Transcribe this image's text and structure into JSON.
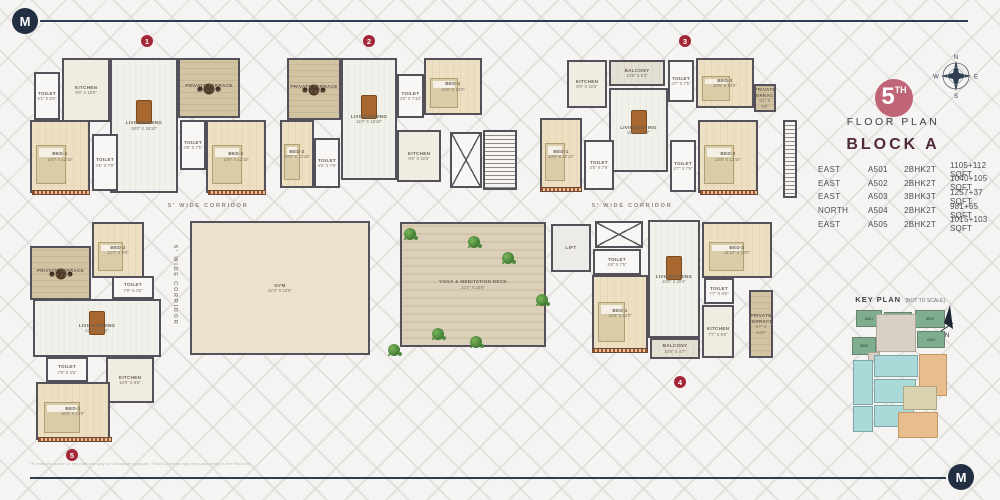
{
  "logo": {
    "letter": "M"
  },
  "panel": {
    "compass": {
      "n": "N",
      "e": "E",
      "s": "S",
      "w": "W"
    },
    "floor_badge": {
      "number": "5",
      "suffix": "TH"
    },
    "floor_label": "FLOOR PLAN",
    "block_title": "BLOCK A",
    "accent_colors": {
      "badge": "#c06577",
      "marker": "#a32638",
      "navy": "#2e3d52",
      "title": "#4f2b37"
    },
    "units_table": {
      "rows": [
        {
          "facing": "EAST",
          "unit": "A501",
          "type": "2BHK2T",
          "area": "1105+112 SQFT"
        },
        {
          "facing": "EAST",
          "unit": "A502",
          "type": "2BHK2T",
          "area": "1040+105 SQFT"
        },
        {
          "facing": "EAST",
          "unit": "A503",
          "type": "3BHK3T",
          "area": "1257+37 SQFT"
        },
        {
          "facing": "NORTH",
          "unit": "A504",
          "type": "2BHK2T",
          "area": "981+65 SQFT"
        },
        {
          "facing": "EAST",
          "unit": "A505",
          "type": "2BHK2T",
          "area": "1015+103 SQFT"
        }
      ]
    },
    "key_plan": {
      "title": "KEY PLAN",
      "note": "[NOT TO SCALE]",
      "north_label": "N",
      "colors": {
        "green": "#7fae8e",
        "teal": "#abd8d8",
        "orange": "#e9bd8d",
        "beige": "#d9d2b0",
        "corridor": "#d8d0c4"
      },
      "blocks": [
        {
          "x": 856,
          "y": 310,
          "w": 26,
          "h": 17,
          "c": "g",
          "label": "A501"
        },
        {
          "x": 884,
          "y": 312,
          "w": 28,
          "h": 16,
          "c": "g",
          "label": "A502"
        },
        {
          "x": 915,
          "y": 310,
          "w": 30,
          "h": 18,
          "c": "g",
          "label": "A503"
        },
        {
          "x": 852,
          "y": 337,
          "w": 24,
          "h": 18,
          "c": "g",
          "label": "A505"
        },
        {
          "x": 917,
          "y": 331,
          "w": 28,
          "h": 17,
          "c": "g",
          "label": "A504"
        },
        {
          "x": 876,
          "y": 314,
          "w": 40,
          "h": 38,
          "c": "cor",
          "label": ""
        },
        {
          "x": 868,
          "y": 352,
          "w": 12,
          "h": 10,
          "c": "cor",
          "label": ""
        },
        {
          "x": 874,
          "y": 355,
          "w": 44,
          "h": 22,
          "c": "t",
          "label": ""
        },
        {
          "x": 874,
          "y": 379,
          "w": 42,
          "h": 24,
          "c": "t",
          "label": ""
        },
        {
          "x": 874,
          "y": 405,
          "w": 40,
          "h": 22,
          "c": "t",
          "label": ""
        },
        {
          "x": 853,
          "y": 360,
          "w": 20,
          "h": 45,
          "c": "t",
          "label": ""
        },
        {
          "x": 853,
          "y": 406,
          "w": 20,
          "h": 26,
          "c": "t",
          "label": ""
        },
        {
          "x": 919,
          "y": 354,
          "w": 28,
          "h": 42,
          "c": "o",
          "label": ""
        },
        {
          "x": 898,
          "y": 412,
          "w": 40,
          "h": 26,
          "c": "o",
          "label": ""
        },
        {
          "x": 903,
          "y": 386,
          "w": 34,
          "h": 24,
          "c": "be",
          "label": ""
        }
      ]
    }
  },
  "floor_plan": {
    "corridor_label": "5' WIDE CORRIDOR",
    "markers": [
      {
        "n": "1",
        "x": 141,
        "y": 35
      },
      {
        "n": "2",
        "x": 363,
        "y": 35
      },
      {
        "n": "3",
        "x": 679,
        "y": 35
      },
      {
        "n": "4",
        "x": 674,
        "y": 376
      },
      {
        "n": "5",
        "x": 66,
        "y": 449
      }
    ],
    "rooms": [
      {
        "id": "u1-toilet-a",
        "name": "TOILET",
        "dims": "5'1\" X 8'0\"",
        "x": 34,
        "y": 72,
        "w": 26,
        "h": 48,
        "k": "wet",
        "f": ""
      },
      {
        "id": "u1-kitchen",
        "name": "KITCHEN",
        "dims": "9'6\" X 10'6\"",
        "x": 62,
        "y": 58,
        "w": 48,
        "h": 64,
        "k": "kit",
        "f": ""
      },
      {
        "id": "u1-living",
        "name": "LIVING/DINING",
        "dims": "18'0\" X 18'10\"",
        "x": 110,
        "y": 58,
        "w": 68,
        "h": 135,
        "k": "liv",
        "f": "dining"
      },
      {
        "id": "u1-terrace",
        "name": "PRIVATE TERRACE",
        "dims": "10'4\" X 10'10\"",
        "x": 178,
        "y": 58,
        "w": 62,
        "h": 60,
        "k": "ter",
        "f": "tertable"
      },
      {
        "id": "u1-bed1",
        "name": "BED-1",
        "dims": "10'0\" X 12'10\"",
        "x": 30,
        "y": 120,
        "w": 60,
        "h": 73,
        "k": "bed",
        "f": "bed"
      },
      {
        "id": "u1-toilet-b",
        "name": "TOILET",
        "dims": "4'5\" X 7'9\"",
        "x": 92,
        "y": 134,
        "w": 26,
        "h": 57,
        "k": "wet",
        "f": ""
      },
      {
        "id": "u1-toilet-c",
        "name": "TOILET",
        "dims": "4'5\" X 7'5\"",
        "x": 180,
        "y": 120,
        "w": 26,
        "h": 50,
        "k": "wet",
        "f": ""
      },
      {
        "id": "u1-bed2",
        "name": "BED-2",
        "dims": "10'6\" X 12'10\"",
        "x": 206,
        "y": 120,
        "w": 60,
        "h": 73,
        "k": "bed",
        "f": "bed"
      },
      {
        "id": "u2-terrace",
        "name": "PRIVATE TERRACE",
        "dims": "9'8\" X 10'10\"",
        "x": 287,
        "y": 58,
        "w": 54,
        "h": 62,
        "k": "ter",
        "f": "tertable"
      },
      {
        "id": "u2-living",
        "name": "LIVING/DINING",
        "dims": "11'0\" X 18'10\"",
        "x": 341,
        "y": 58,
        "w": 56,
        "h": 122,
        "k": "liv",
        "f": "dining"
      },
      {
        "id": "u2-toilet-a",
        "name": "TOILET",
        "dims": "4'5\" X 7'10\"",
        "x": 397,
        "y": 74,
        "w": 27,
        "h": 44,
        "k": "wet",
        "f": ""
      },
      {
        "id": "u2-bed1",
        "name": "BED-1",
        "dims": "10'6\" X 12'0\"",
        "x": 424,
        "y": 58,
        "w": 58,
        "h": 57,
        "k": "bed",
        "f": "bed"
      },
      {
        "id": "u2-bed2",
        "name": "BED-2",
        "dims": "10'0\" X 12'10\"",
        "x": 280,
        "y": 120,
        "w": 34,
        "h": 68,
        "k": "bed",
        "f": "bed"
      },
      {
        "id": "u2-toilet-b",
        "name": "TOILET",
        "dims": "4'5\" X 7'9\"",
        "x": 314,
        "y": 138,
        "w": 26,
        "h": 50,
        "k": "wet",
        "f": ""
      },
      {
        "id": "u2-kitchen",
        "name": "KITCHEN",
        "dims": "9'2\" X 10'5\"",
        "x": 397,
        "y": 130,
        "w": 44,
        "h": 52,
        "k": "kit",
        "f": ""
      },
      {
        "id": "u3-kitchen",
        "name": "KITCHEN",
        "dims": "8'0\" X 10'6\"",
        "x": 567,
        "y": 60,
        "w": 40,
        "h": 48,
        "k": "kit",
        "f": ""
      },
      {
        "id": "u3-balcony",
        "name": "BALCONY",
        "dims": "10'6\" X 8'3\"",
        "x": 609,
        "y": 60,
        "w": 56,
        "h": 26,
        "k": "bal",
        "f": ""
      },
      {
        "id": "u3-toilet-a",
        "name": "TOILET",
        "dims": "4'7\" X 7'5\"",
        "x": 668,
        "y": 60,
        "w": 26,
        "h": 42,
        "k": "wet",
        "f": ""
      },
      {
        "id": "u3-bed3",
        "name": "BED-3",
        "dims": "10'6\" X 10'6\"",
        "x": 696,
        "y": 58,
        "w": 58,
        "h": 50,
        "k": "bed",
        "f": "bed"
      },
      {
        "id": "u3-terrace",
        "name": "PRIVATE TERRACE",
        "dims": "8'1\" X 9'9\"",
        "x": 754,
        "y": 84,
        "w": 22,
        "h": 28,
        "k": "ter",
        "f": ""
      },
      {
        "id": "u3-living",
        "name": "LIVING/DINING",
        "dims": "11'0\" X 16'7\"",
        "x": 609,
        "y": 88,
        "w": 59,
        "h": 84,
        "k": "liv",
        "f": "dining"
      },
      {
        "id": "u3-bed1",
        "name": "BED-1",
        "dims": "10'6\" X 12'10\"",
        "x": 540,
        "y": 118,
        "w": 42,
        "h": 72,
        "k": "bed",
        "f": "bed"
      },
      {
        "id": "u3-toilet-b",
        "name": "TOILET",
        "dims": "4'5\" X 7'9\"",
        "x": 584,
        "y": 140,
        "w": 30,
        "h": 50,
        "k": "wet",
        "f": ""
      },
      {
        "id": "u3-toilet-c",
        "name": "TOILET",
        "dims": "4'7\" X 7'9\"",
        "x": 670,
        "y": 140,
        "w": 26,
        "h": 52,
        "k": "wet",
        "f": ""
      },
      {
        "id": "u3-bed2",
        "name": "BED-2",
        "dims": "10'6\" X 12'10\"",
        "x": 698,
        "y": 120,
        "w": 60,
        "h": 73,
        "k": "bed",
        "f": "bed"
      },
      {
        "id": "u4-toilet-a",
        "name": "TOILET",
        "dims": "5'8\" X 7'5\"",
        "x": 593,
        "y": 249,
        "w": 48,
        "h": 26,
        "k": "wet",
        "f": ""
      },
      {
        "id": "u4-bed1",
        "name": "BED-1",
        "dims": "10'6\" X 12'0\"",
        "x": 592,
        "y": 275,
        "w": 56,
        "h": 76,
        "k": "bed",
        "f": "bed"
      },
      {
        "id": "u4-living",
        "name": "LIVING/DINING",
        "dims": "10'0\" X 20'4\"",
        "x": 648,
        "y": 220,
        "w": 52,
        "h": 118,
        "k": "liv",
        "f": "dining"
      },
      {
        "id": "u4-bed2",
        "name": "BED-2",
        "dims": "11'10\" X 10'0\"",
        "x": 702,
        "y": 222,
        "w": 70,
        "h": 56,
        "k": "bed",
        "f": "bed"
      },
      {
        "id": "u4-toilet-b",
        "name": "TOILET",
        "dims": "7'7\" X 4'5\"",
        "x": 704,
        "y": 278,
        "w": 30,
        "h": 26,
        "k": "wet",
        "f": ""
      },
      {
        "id": "u4-kitchen",
        "name": "KITCHEN",
        "dims": "7'7\" X 9'6\"",
        "x": 702,
        "y": 305,
        "w": 32,
        "h": 53,
        "k": "kit",
        "f": ""
      },
      {
        "id": "u4-terrace",
        "name": "PRIVATE TERRACE",
        "dims": "4'7\" X 14'5\"",
        "x": 749,
        "y": 290,
        "w": 24,
        "h": 68,
        "k": "ter",
        "f": ""
      },
      {
        "id": "u4-balcony",
        "name": "BALCONY",
        "dims": "10'0\" X 4'7\"",
        "x": 650,
        "y": 338,
        "w": 50,
        "h": 21,
        "k": "bal",
        "f": ""
      },
      {
        "id": "u5-bed2",
        "name": "BED-2",
        "dims": "12'7\" X 9'8\"",
        "x": 92,
        "y": 222,
        "w": 52,
        "h": 56,
        "k": "bed",
        "f": "bed"
      },
      {
        "id": "u5-terrace",
        "name": "PRIVATE TERRACE",
        "dims": "12'3\" X 9'8\"",
        "x": 30,
        "y": 246,
        "w": 61,
        "h": 54,
        "k": "ter",
        "f": "tertable"
      },
      {
        "id": "u5-toilet-a",
        "name": "TOILET",
        "dims": "7'9\" X 4'5\"",
        "x": 112,
        "y": 276,
        "w": 42,
        "h": 23,
        "k": "wet",
        "f": ""
      },
      {
        "id": "u5-living",
        "name": "LIVING/DINING",
        "dims": "23'3\" X 10'0\"",
        "x": 33,
        "y": 299,
        "w": 128,
        "h": 58,
        "k": "liv",
        "f": "dining"
      },
      {
        "id": "u5-toilet-b",
        "name": "TOILET",
        "dims": "7'9\" X 4'5\"",
        "x": 46,
        "y": 357,
        "w": 42,
        "h": 25,
        "k": "wet",
        "f": ""
      },
      {
        "id": "u5-kitchen",
        "name": "KITCHEN",
        "dims": "10'0\" X 9'6\"",
        "x": 106,
        "y": 357,
        "w": 48,
        "h": 46,
        "k": "kit",
        "f": ""
      },
      {
        "id": "u5-bed1",
        "name": "BED-1",
        "dims": "10'6\" X 13'0\"",
        "x": 36,
        "y": 382,
        "w": 74,
        "h": 58,
        "k": "bed",
        "f": "bed"
      },
      {
        "id": "gym",
        "name": "GYM",
        "dims": "32'4\" X 23'0\"",
        "x": 190,
        "y": 221,
        "w": 180,
        "h": 134,
        "k": "gym",
        "f": ""
      },
      {
        "id": "yoga-deck",
        "name": "YOGA & MEDITATION DECK",
        "dims": "32'4\" X 23'6\"",
        "x": 400,
        "y": 222,
        "w": 146,
        "h": 125,
        "k": "deck",
        "f": ""
      },
      {
        "id": "lift",
        "name": "LIFT",
        "dims": "",
        "x": 551,
        "y": 224,
        "w": 40,
        "h": 48,
        "k": "lift",
        "f": ""
      }
    ],
    "stairs": [
      {
        "x": 483,
        "y": 130,
        "w": 34,
        "h": 60
      },
      {
        "x": 783,
        "y": 120,
        "w": 14,
        "h": 78
      }
    ],
    "shafts": [
      {
        "x": 450,
        "y": 132,
        "w": 32,
        "h": 56
      },
      {
        "x": 595,
        "y": 221,
        "w": 48,
        "h": 27
      }
    ],
    "railings": [
      {
        "x": 32,
        "y": 190,
        "w": 58,
        "h": 5
      },
      {
        "x": 208,
        "y": 190,
        "w": 58,
        "h": 5
      },
      {
        "x": 700,
        "y": 190,
        "w": 58,
        "h": 5
      },
      {
        "x": 540,
        "y": 187,
        "w": 42,
        "h": 5
      },
      {
        "x": 592,
        "y": 348,
        "w": 56,
        "h": 5
      },
      {
        "x": 38,
        "y": 437,
        "w": 74,
        "h": 5
      }
    ],
    "plants": [
      {
        "x": 404,
        "y": 228
      },
      {
        "x": 468,
        "y": 236
      },
      {
        "x": 502,
        "y": 252
      },
      {
        "x": 536,
        "y": 294
      },
      {
        "x": 432,
        "y": 328
      },
      {
        "x": 470,
        "y": 336
      },
      {
        "x": 388,
        "y": 344
      }
    ]
  },
  "footer": {
    "disclaimer": "*Furnitures shown in the plan are only for indicative purpose. *Sizes & areas may vary according to the final unit."
  }
}
